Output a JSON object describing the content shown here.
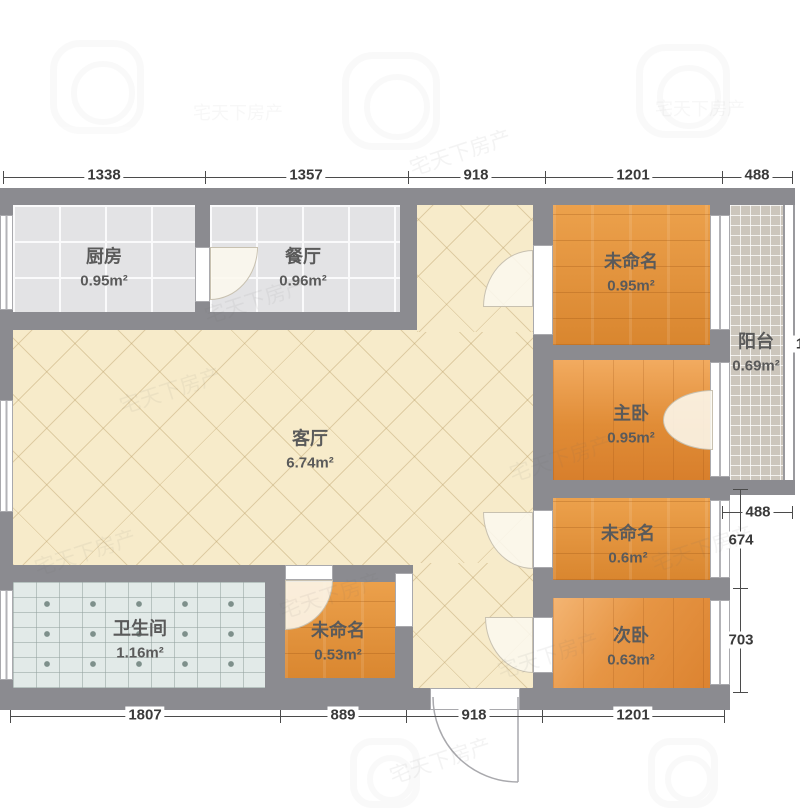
{
  "plan": {
    "rooms": {
      "kitchen": {
        "name": "厨房",
        "area": "0.95m²"
      },
      "dining": {
        "name": "餐厅",
        "area": "0.96m²"
      },
      "living": {
        "name": "客厅",
        "area": "6.74m²"
      },
      "room_top_right": {
        "name": "未命名",
        "area": "0.95m²"
      },
      "balcony": {
        "name": "阳台",
        "area": "0.69m²"
      },
      "master": {
        "name": "主卧",
        "area": "0.95m²"
      },
      "room_mid_right": {
        "name": "未命名",
        "area": "0.6m²"
      },
      "bedroom2": {
        "name": "次卧",
        "area": "0.63m²"
      },
      "bathroom": {
        "name": "卫生间",
        "area": "1.16m²"
      },
      "room_bottom": {
        "name": "未命名",
        "area": "0.53m²"
      }
    },
    "dimensions": {
      "top": {
        "d1": "1338",
        "d2": "1357",
        "d3": "918",
        "d4": "1201",
        "d5": "488"
      },
      "bottom": {
        "d1": "1807",
        "d2": "889",
        "d3": "918",
        "d4": "1201"
      },
      "right": {
        "d1": "488",
        "d2": "674",
        "d3": "703",
        "edge_partial": "1"
      }
    },
    "watermark": {
      "text": "宅天下房产"
    }
  }
}
